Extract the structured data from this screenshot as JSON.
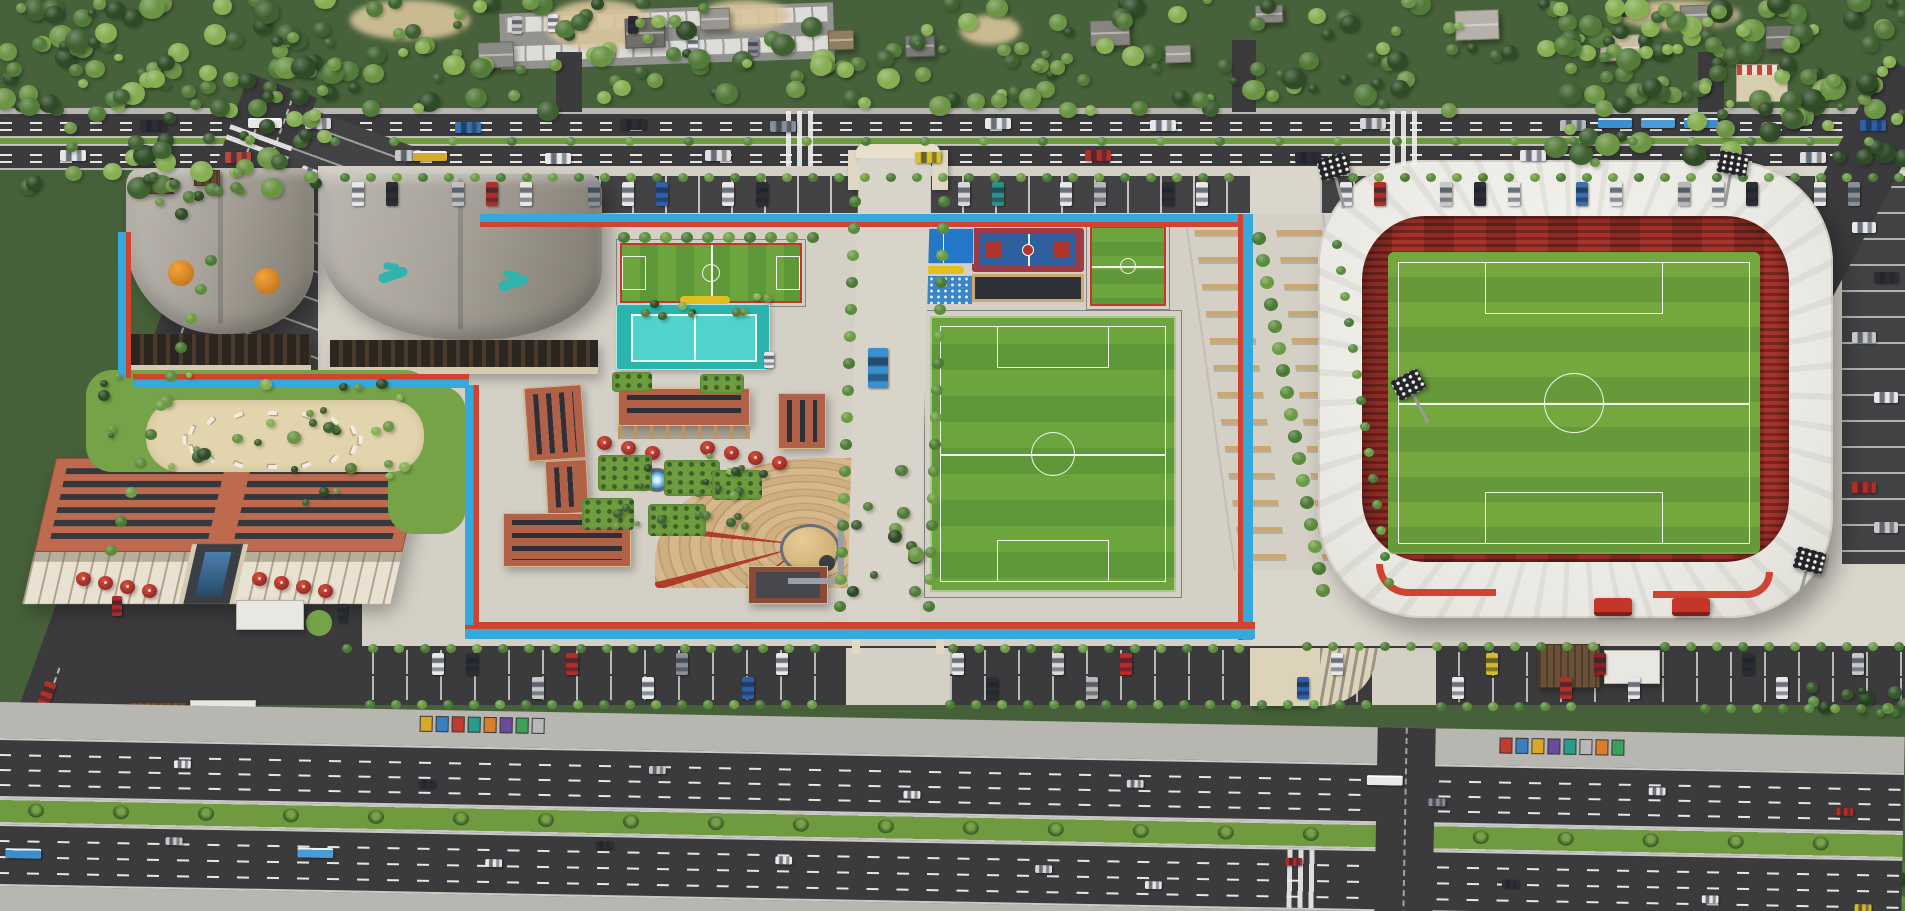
{
  "palette": {
    "bg": "#46613a",
    "concrete": "#d4d0c6",
    "plaza": "#dad6cc",
    "asphalt": "#3b3b3d",
    "asphalt2": "#434345",
    "sidewalk": "#b8b6b0",
    "tblue": "#35a8dc",
    "tred": "#cf4330",
    "grass": "#76a348",
    "median": "#6f9a40",
    "field1": "#6ca43e",
    "field2": "#5f9838",
    "pitch1": "#74a83e",
    "pitch2": "#659939",
    "teal1": "#2bb3ae",
    "teal2": "#52d2cc",
    "terra": "#b06148",
    "brick": "#8a4a38",
    "hotelroof": "#bd6a4f",
    "cream": "#e9e2d2",
    "seatred": "#a7342c",
    "sand": "#e2d4ac",
    "yellow": "#e2bf20",
    "bench": "#c9a873"
  },
  "tree_greens": [
    "#2e4a26",
    "#3f6030",
    "#527a38",
    "#6b9444",
    "#86ae52"
  ],
  "tree_dark": [
    "#24421f",
    "#33562a",
    "#487334",
    "#5d8c3e"
  ],
  "hedge_greens": [
    "#4a7a34",
    "#5a8c3c",
    "#6b9c44"
  ],
  "tree_regions": [
    [
      0,
      0,
      1905,
      112,
      260,
      4,
      12,
      0
    ],
    [
      0,
      0,
      335,
      190,
      80,
      5,
      13,
      0
    ],
    [
      1555,
      0,
      350,
      165,
      80,
      5,
      13,
      0
    ],
    [
      0,
      795,
      445,
      116,
      95,
      6,
      14,
      1
    ],
    [
      380,
      868,
      1525,
      43,
      115,
      5,
      12,
      1
    ],
    [
      88,
      374,
      335,
      96,
      26,
      3,
      7,
      0
    ],
    [
      560,
      448,
      235,
      80,
      22,
      3,
      5,
      0
    ],
    [
      600,
      296,
      180,
      22,
      10,
      3,
      5,
      0
    ],
    [
      840,
      470,
      88,
      128,
      12,
      4,
      8,
      0
    ],
    [
      1790,
      686,
      115,
      28,
      12,
      4,
      8,
      1
    ],
    [
      128,
      166,
      115,
      52,
      12,
      4,
      7,
      0
    ],
    [
      300,
      368,
      90,
      150,
      10,
      3,
      6,
      0
    ]
  ],
  "hedges": [
    [
      340,
      173,
      35,
      26,
      0,
      5
    ],
    [
      1322,
      173,
      23,
      26,
      0,
      5
    ],
    [
      618,
      232,
      10,
      21,
      0,
      6
    ],
    [
      849,
      196,
      16,
      -1,
      27,
      6
    ],
    [
      938,
      196,
      16,
      -1,
      27,
      6
    ],
    [
      1252,
      232,
      17,
      4,
      22,
      7
    ],
    [
      342,
      644,
      19,
      26,
      0,
      5
    ],
    [
      948,
      644,
      12,
      26,
      0,
      5
    ],
    [
      1302,
      642,
      12,
      26,
      0,
      5
    ],
    [
      1660,
      642,
      10,
      26,
      0,
      5
    ],
    [
      365,
      700,
      18,
      26,
      0,
      5
    ],
    [
      945,
      700,
      17,
      26,
      0,
      5
    ],
    [
      1436,
      702,
      6,
      26,
      0,
      5
    ],
    [
      1700,
      704,
      8,
      26,
      0,
      5
    ],
    [
      330,
      137,
      27,
      59,
      0,
      5
    ],
    [
      1332,
      240,
      14,
      4,
      26,
      5
    ],
    [
      205,
      255,
      11,
      -10,
      29,
      6
    ]
  ],
  "north": {
    "houses": [
      [
        478,
        42,
        36,
        26,
        "#8a8a86"
      ],
      [
        625,
        18,
        40,
        30,
        "#6e6e6a"
      ],
      [
        700,
        8,
        30,
        22,
        "#9a9792"
      ],
      [
        828,
        30,
        26,
        20,
        "#8f7f5f"
      ],
      [
        905,
        35,
        30,
        22,
        "#7a7a76"
      ],
      [
        1090,
        20,
        40,
        26,
        "#87857f"
      ],
      [
        1165,
        45,
        26,
        18,
        "#9a9792"
      ],
      [
        1255,
        5,
        28,
        18,
        "#8a8a86"
      ],
      [
        1455,
        10,
        44,
        30,
        "#b5b2aa"
      ],
      [
        1600,
        35,
        40,
        26,
        "#c9bfa4"
      ],
      [
        1680,
        5,
        30,
        20,
        "#8a8a86"
      ],
      [
        1765,
        25,
        34,
        24,
        "#76766f"
      ]
    ],
    "sand": [
      [
        350,
        0,
        120,
        40
      ],
      [
        545,
        0,
        110,
        50
      ],
      [
        700,
        0,
        90,
        30
      ],
      [
        960,
        15,
        60,
        30
      ],
      [
        1620,
        0,
        120,
        30
      ]
    ]
  },
  "vehicles": {
    "top_road": [
      [
        60,
        150,
        "#e8e8e8"
      ],
      [
        140,
        120,
        "#2e2e32"
      ],
      [
        225,
        152,
        "#b84a3a"
      ],
      [
        305,
        118,
        "#d8d8d8"
      ],
      [
        395,
        150,
        "#c8c8c8"
      ],
      [
        455,
        122,
        "#3a6fb0"
      ],
      [
        545,
        153,
        "#e8e8e8"
      ],
      [
        620,
        119,
        "#2e2e32"
      ],
      [
        705,
        150,
        "#e0e0e0"
      ],
      [
        770,
        121,
        "#8a8f96"
      ],
      [
        915,
        152,
        "#d8c030"
      ],
      [
        985,
        118,
        "#e8e8e8"
      ],
      [
        1085,
        150,
        "#b03028"
      ],
      [
        1150,
        120,
        "#e8e8e8"
      ],
      [
        1295,
        152,
        "#2e2e32"
      ],
      [
        1360,
        118,
        "#d8d8d8"
      ],
      [
        1520,
        150,
        "#e8e8e8"
      ],
      [
        1560,
        120,
        "#b8b8b8"
      ],
      [
        1800,
        152,
        "#e0e0e0"
      ],
      [
        1860,
        120,
        "#2e5fa8"
      ]
    ],
    "top_buses": [
      [
        413,
        151,
        "#d8a830"
      ],
      [
        1598,
        118,
        "#3a8fd0"
      ],
      [
        1641,
        118,
        "#4a9ad8"
      ],
      [
        1684,
        118,
        "#3a8fd0"
      ],
      [
        248,
        118,
        "#e8e8e8"
      ]
    ],
    "north_parking": [
      [
        352,
        "#e8e8e8"
      ],
      [
        386,
        "#2e2e32"
      ],
      [
        452,
        "#c0c0c0"
      ],
      [
        486,
        "#b03028"
      ],
      [
        520,
        "#e8e8e8"
      ],
      [
        588,
        "#8a8f96"
      ],
      [
        622,
        "#e8e8e8"
      ],
      [
        656,
        "#2e5fa8"
      ],
      [
        722,
        "#e8e8e8"
      ],
      [
        756,
        "#2e2e32"
      ],
      [
        958,
        "#d8d8d8"
      ],
      [
        992,
        "#2e8f8a"
      ],
      [
        1060,
        "#e8e8e8"
      ],
      [
        1094,
        "#b8b8b8"
      ],
      [
        1162,
        "#2e2e32"
      ],
      [
        1196,
        "#e8e8e8"
      ],
      [
        1340,
        "#e8e8e8"
      ],
      [
        1374,
        "#b03028"
      ],
      [
        1440,
        "#c8c8c8"
      ],
      [
        1474,
        "#2e2e32"
      ],
      [
        1508,
        "#e8e8e8"
      ],
      [
        1576,
        "#3a6fb0"
      ],
      [
        1610,
        "#e8e8e8"
      ],
      [
        1678,
        "#b8b8b8"
      ],
      [
        1712,
        "#e8e8e8"
      ],
      [
        1746,
        "#2e2e32"
      ],
      [
        1814,
        "#e8e8e8"
      ],
      [
        1848,
        "#8a8f96"
      ]
    ],
    "south_parking": [
      [
        432,
        653,
        "#e8e8e8"
      ],
      [
        466,
        653,
        "#2e2e32"
      ],
      [
        532,
        677,
        "#c8c8c8"
      ],
      [
        566,
        653,
        "#b03028"
      ],
      [
        642,
        677,
        "#e8e8e8"
      ],
      [
        676,
        653,
        "#8a8f96"
      ],
      [
        742,
        677,
        "#2e5fa8"
      ],
      [
        776,
        653,
        "#e8e8e8"
      ],
      [
        952,
        653,
        "#e8e8e8"
      ],
      [
        986,
        677,
        "#2e2e32"
      ],
      [
        1052,
        653,
        "#d8d8d8"
      ],
      [
        1086,
        677,
        "#b8b8b8"
      ],
      [
        1120,
        653,
        "#c02828"
      ],
      [
        1297,
        677,
        "#2e5fa8"
      ],
      [
        1331,
        653,
        "#e8e8e8"
      ],
      [
        1452,
        677,
        "#e8e8e8"
      ],
      [
        1486,
        653,
        "#d8b82a"
      ],
      [
        1560,
        677,
        "#b03028"
      ],
      [
        1594,
        653,
        "#8a2020"
      ],
      [
        1628,
        677,
        "#e8e8e8"
      ],
      [
        1742,
        653,
        "#2e2e32"
      ],
      [
        1776,
        677,
        "#e8e8e8"
      ],
      [
        1852,
        653,
        "#c8c8c8"
      ]
    ],
    "boulevard_cars": [
      [
        175,
        55,
        "#e8e8e8"
      ],
      [
        420,
        70,
        "#2e2e32"
      ],
      [
        650,
        52,
        "#c8c8c8"
      ],
      [
        905,
        72,
        "#e8e8e8"
      ],
      [
        1128,
        57,
        "#d8d8d8"
      ],
      [
        1430,
        70,
        "#8a8f96"
      ],
      [
        1650,
        55,
        "#e8e8e8"
      ],
      [
        1838,
        72,
        "#b03028"
      ],
      [
        168,
        132,
        "#c8c8c8"
      ],
      [
        488,
        148,
        "#e8e8e8"
      ],
      [
        598,
        128,
        "#2e2e32"
      ],
      [
        778,
        140,
        "#e8e8e8"
      ],
      [
        1038,
        144,
        "#d8d8d8"
      ],
      [
        1148,
        158,
        "#e8e8e8"
      ],
      [
        1288,
        132,
        "#b02828"
      ],
      [
        1505,
        150,
        "#2e2e32"
      ],
      [
        1705,
        162,
        "#e8e8e8"
      ],
      [
        1858,
        168,
        "#d8b82a"
      ]
    ],
    "boulevard_buses": [
      [
        8,
        146,
        "#3a8fd0"
      ],
      [
        300,
        140,
        "#4a9ad8"
      ],
      [
        1368,
        48,
        "#e8e8e8"
      ]
    ],
    "left_road": [
      [
        14,
        150,
        "#e8e8e8"
      ],
      [
        40,
        230,
        "#c8c8c8"
      ],
      [
        12,
        520,
        "#2e2e32"
      ],
      [
        42,
        590,
        "#e8e8e8"
      ],
      [
        16,
        640,
        "#b03028"
      ]
    ],
    "left_road_bus": [
      [
        8,
        320,
        "#3a8fd0"
      ]
    ],
    "left_parking": [
      [
        16,
        55,
        "#e8e8e8"
      ],
      [
        58,
        95,
        "#2e2e32"
      ],
      [
        20,
        195,
        "#c8c8c8"
      ],
      [
        62,
        245,
        "#e8e8e8"
      ],
      [
        18,
        350,
        "#b03028"
      ],
      [
        60,
        395,
        "#d8c030"
      ],
      [
        28,
        435,
        "#8a2030"
      ]
    ],
    "stadium_lot": [
      [
        10,
        36,
        "#e8e8e8"
      ],
      [
        32,
        86,
        "#2e2e32"
      ],
      [
        10,
        146,
        "#c8c8c8"
      ],
      [
        32,
        206,
        "#e8e8e8"
      ],
      [
        10,
        296,
        "#b03028"
      ],
      [
        32,
        336,
        "#c8c8c8"
      ]
    ],
    "misc": [
      [
        112,
        596,
        10,
        20,
        "#b02828"
      ],
      [
        338,
        604,
        9,
        18,
        "#2e2e32"
      ],
      [
        868,
        348,
        20,
        40,
        "#3a8fd0"
      ],
      [
        764,
        352,
        10,
        16,
        "#e8e8e8"
      ],
      [
        512,
        16,
        10,
        18,
        "#c8c8c8"
      ],
      [
        548,
        14,
        10,
        18,
        "#e8e8e8"
      ],
      [
        628,
        16,
        10,
        18,
        "#2e2e32"
      ],
      [
        688,
        36,
        10,
        18,
        "#e8e8e8"
      ],
      [
        748,
        38,
        10,
        18,
        "#8a8f96"
      ]
    ]
  },
  "billboards": [
    {
      "x": 420,
      "y": 6,
      "colors": [
        "#d8a826",
        "#3a7fc0",
        "#c03a30",
        "#2a9a8a",
        "#d87f2a",
        "#6a4a9a",
        "#3aa05a",
        "#b8b8b8"
      ]
    },
    {
      "x": 1500,
      "y": 8,
      "colors": [
        "#c03a30",
        "#3a7fc0",
        "#d8a826",
        "#6a4a9a",
        "#2a9a8a",
        "#b8b8b8",
        "#d87f2a",
        "#3aa05a"
      ]
    }
  ],
  "palm_xs": [
    30,
    115,
    200,
    285,
    370,
    455,
    540,
    625,
    710,
    795,
    880,
    965,
    1050,
    1135,
    1220,
    1305,
    1475,
    1560,
    1645,
    1730,
    1815
  ],
  "umbrellas": {
    "hotel": [
      [
        76,
        572
      ],
      [
        98,
        576
      ],
      [
        120,
        580
      ],
      [
        142,
        584
      ],
      [
        252,
        572
      ],
      [
        274,
        576
      ],
      [
        296,
        580
      ],
      [
        318,
        584
      ]
    ],
    "plaza": [
      [
        597,
        436
      ],
      [
        621,
        441
      ],
      [
        645,
        446
      ],
      [
        700,
        441
      ],
      [
        724,
        446
      ],
      [
        748,
        451
      ],
      [
        772,
        456
      ]
    ]
  },
  "planters": [
    [
      598,
      455,
      54,
      36
    ],
    [
      664,
      460,
      56,
      36
    ],
    [
      582,
      498,
      52,
      32
    ],
    [
      648,
      504,
      58,
      32
    ],
    [
      712,
      470,
      50,
      30
    ],
    [
      612,
      372,
      40,
      20
    ],
    [
      700,
      374,
      44,
      20
    ]
  ],
  "loungers": {
    "cx": 268,
    "cy": 438,
    "rx": 88,
    "ry": 27,
    "n": 16
  },
  "floodlights": [
    [
      1316,
      160,
      -15
    ],
    [
      1720,
      150,
      10
    ],
    [
      1390,
      382,
      -28
    ],
    [
      1798,
      546,
      15
    ]
  ],
  "ewalk_benches": {
    "rows": 13,
    "y0": 16,
    "step": 27,
    "cols": [
      6,
      88
    ]
  }
}
